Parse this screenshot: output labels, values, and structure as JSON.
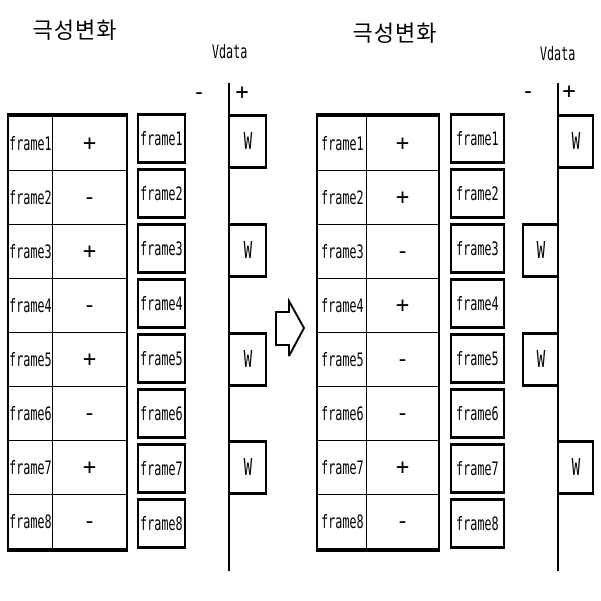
{
  "meta": {
    "ink_color": "#000000",
    "background_color": "#ffffff"
  },
  "arrow": {
    "icon": "block-arrow-right"
  },
  "panels": [
    {
      "title": "극성변화",
      "axis": {
        "label": "Vdata",
        "minus": "-",
        "plus": "+"
      },
      "rows": [
        {
          "frame": "frame1",
          "polarity": "+"
        },
        {
          "frame": "frame2",
          "polarity": "-"
        },
        {
          "frame": "frame3",
          "polarity": "+"
        },
        {
          "frame": "frame4",
          "polarity": "-"
        },
        {
          "frame": "frame5",
          "polarity": "+"
        },
        {
          "frame": "frame6",
          "polarity": "-"
        },
        {
          "frame": "frame7",
          "polarity": "+"
        },
        {
          "frame": "frame8",
          "polarity": "-"
        }
      ],
      "w_marks": [
        {
          "frame": "frame1",
          "side": "plus",
          "label": "W"
        },
        {
          "frame": "frame3",
          "side": "plus",
          "label": "W"
        },
        {
          "frame": "frame5",
          "side": "plus",
          "label": "W"
        },
        {
          "frame": "frame7",
          "side": "plus",
          "label": "W"
        }
      ]
    },
    {
      "title": "극성변화",
      "axis": {
        "label": "Vdata",
        "minus": "-",
        "plus": "+"
      },
      "rows": [
        {
          "frame": "frame1",
          "polarity": "+"
        },
        {
          "frame": "frame2",
          "polarity": "+"
        },
        {
          "frame": "frame3",
          "polarity": "-"
        },
        {
          "frame": "frame4",
          "polarity": "+"
        },
        {
          "frame": "frame5",
          "polarity": "-"
        },
        {
          "frame": "frame6",
          "polarity": "-"
        },
        {
          "frame": "frame7",
          "polarity": "+"
        },
        {
          "frame": "frame8",
          "polarity": "-"
        }
      ],
      "w_marks": [
        {
          "frame": "frame1",
          "side": "plus",
          "label": "W"
        },
        {
          "frame": "frame3",
          "side": "minus",
          "label": "W"
        },
        {
          "frame": "frame5",
          "side": "minus",
          "label": "W"
        },
        {
          "frame": "frame7",
          "side": "plus",
          "label": "W"
        }
      ]
    }
  ]
}
